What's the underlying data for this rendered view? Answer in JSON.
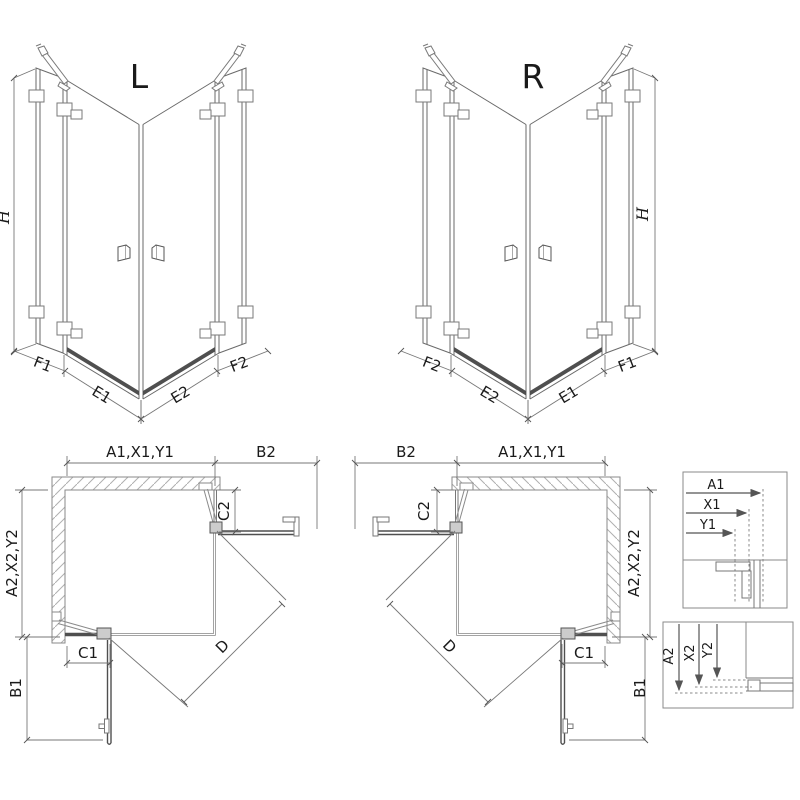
{
  "figure": {
    "type": "technical-drawing",
    "subject": "corner shower enclosure with two hinged doors, left (L) and right (R) variants, isometric views, plan views and profile detail boxes",
    "colors": {
      "line": "#666666",
      "dim_line": "#777777",
      "dark_panel": "#4f4f4f",
      "text": "#1a1a1a",
      "background": "#ffffff"
    }
  },
  "iso_left": {
    "title": "L",
    "h_label": "H",
    "dims": {
      "f1": "F1",
      "e1": "E1",
      "e2": "E2",
      "f2": "F2"
    }
  },
  "iso_right": {
    "title": "R",
    "h_label": "H",
    "dims": {
      "f1": "F1",
      "e1": "E1",
      "e2": "E2",
      "f2": "F2"
    }
  },
  "plan_left": {
    "top": "A1,X1,Y1",
    "b2": "B2",
    "c2": "C2",
    "left": "A2,X2,Y2",
    "c1": "C1",
    "b1": "B1",
    "d": "D"
  },
  "plan_right": {
    "top": "A1,X1,Y1",
    "b2": "B2",
    "c2": "C2",
    "left": "A2,X2,Y2",
    "c1": "C1",
    "b1": "B1",
    "d": "D"
  },
  "detail_top": {
    "rows": [
      "A1",
      "X1",
      "Y1"
    ]
  },
  "detail_bottom": {
    "rows": [
      "A2",
      "X2",
      "Y2"
    ]
  }
}
